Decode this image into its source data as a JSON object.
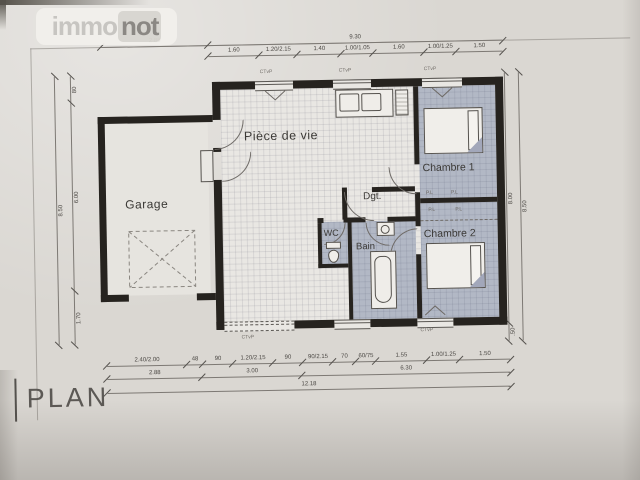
{
  "logo": {
    "part1": "immo",
    "part2": "not"
  },
  "plan_title": "PLAN",
  "rooms": {
    "garage": "Garage",
    "piece_de_vie": "Pièce de vie",
    "chambre1": "Chambre 1",
    "chambre2": "Chambre 2",
    "dgt": "Dgt.",
    "wc": "WC",
    "bain": "Bain"
  },
  "window_tags": {
    "top1": "CTvP",
    "top2": "CTvP",
    "top3": "CTvP",
    "bay": "CTvP",
    "chambre2_win": "CTvP"
  },
  "closet_tags": [
    "P.L",
    "P.L",
    "P.L",
    "P.L"
  ],
  "dimensions": {
    "top_overall": [
      "2.88",
      "9.30"
    ],
    "top_segments": [
      "1.60",
      "1.20/2.15",
      "1.40",
      "1.00/1.05",
      "1.60",
      "1.00/1.25",
      "1.50"
    ],
    "left_total": "8.50",
    "left_segments": [
      "80",
      "6.00",
      "1.70"
    ],
    "right_segments": [
      "8.00",
      ".50"
    ],
    "right_total": "8.50",
    "bottom_row1": [
      "2.40/2.00",
      "48",
      "90",
      "1.20/2.15",
      "90",
      "90/2.15",
      "70",
      "60/75",
      "1.55",
      "1.00/1.25",
      "1.50"
    ],
    "bottom_row2": [
      "2.88",
      "3.00",
      "6.30"
    ],
    "bottom_total": "12.18"
  },
  "colors": {
    "paper": "#dad7d2",
    "wall": "#26231f",
    "room_fill": "#b2b8c5",
    "tile": "#e9e7e3",
    "dim_text": "#4c4945",
    "logo_immo": "#c7c5c1",
    "logo_not": "#8b8884"
  }
}
